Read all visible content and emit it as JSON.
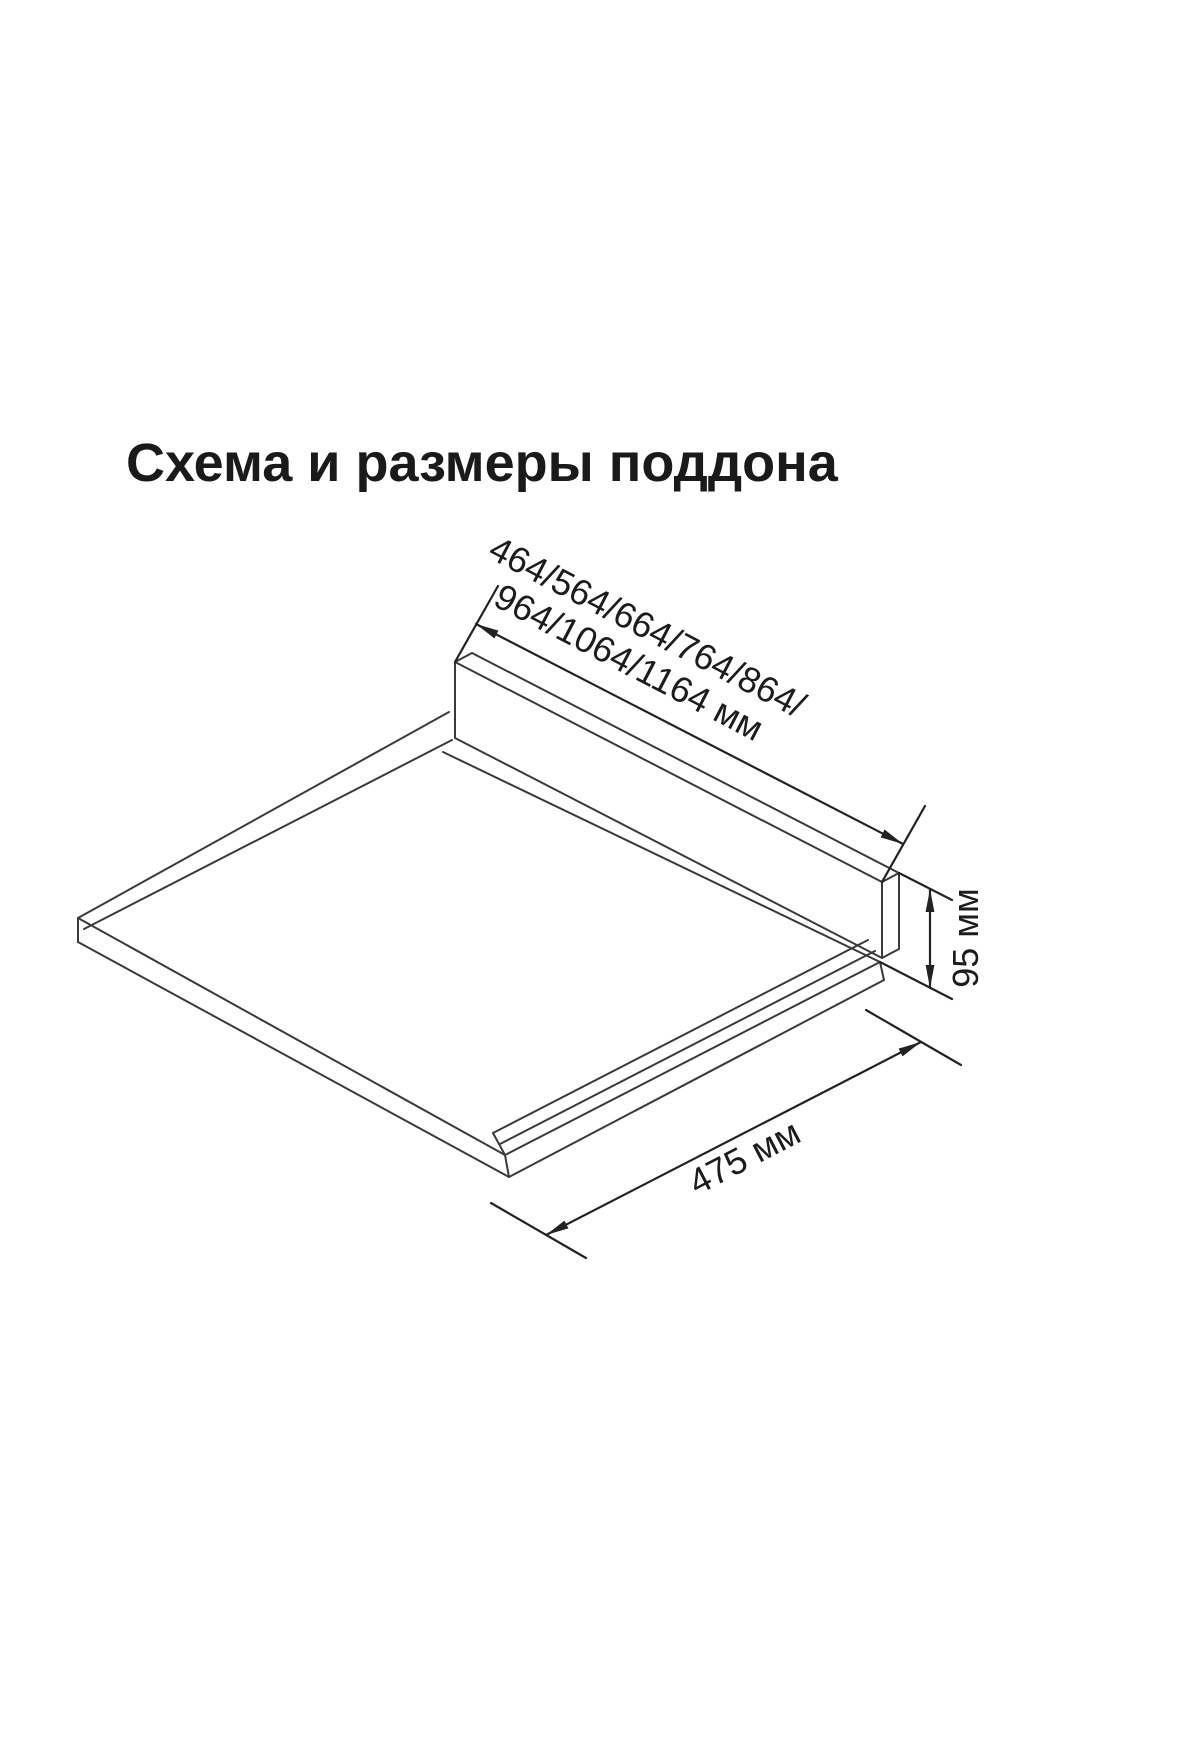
{
  "page": {
    "background": "#ffffff"
  },
  "title": "Схема и размеры поддона",
  "diagram": {
    "subject": "поддон (pallet tray) isometric outline drawing",
    "width_dimension": {
      "label_line1": "464/564/664/764/864/",
      "label_line2": "964/1064/1164 мм"
    },
    "height_dimension": {
      "label": "95 мм"
    },
    "depth_dimension": {
      "label": "475 мм"
    },
    "line_color": "#3a3a3a",
    "dimension_color": "#222222",
    "text_color": "#1c1c1c"
  }
}
